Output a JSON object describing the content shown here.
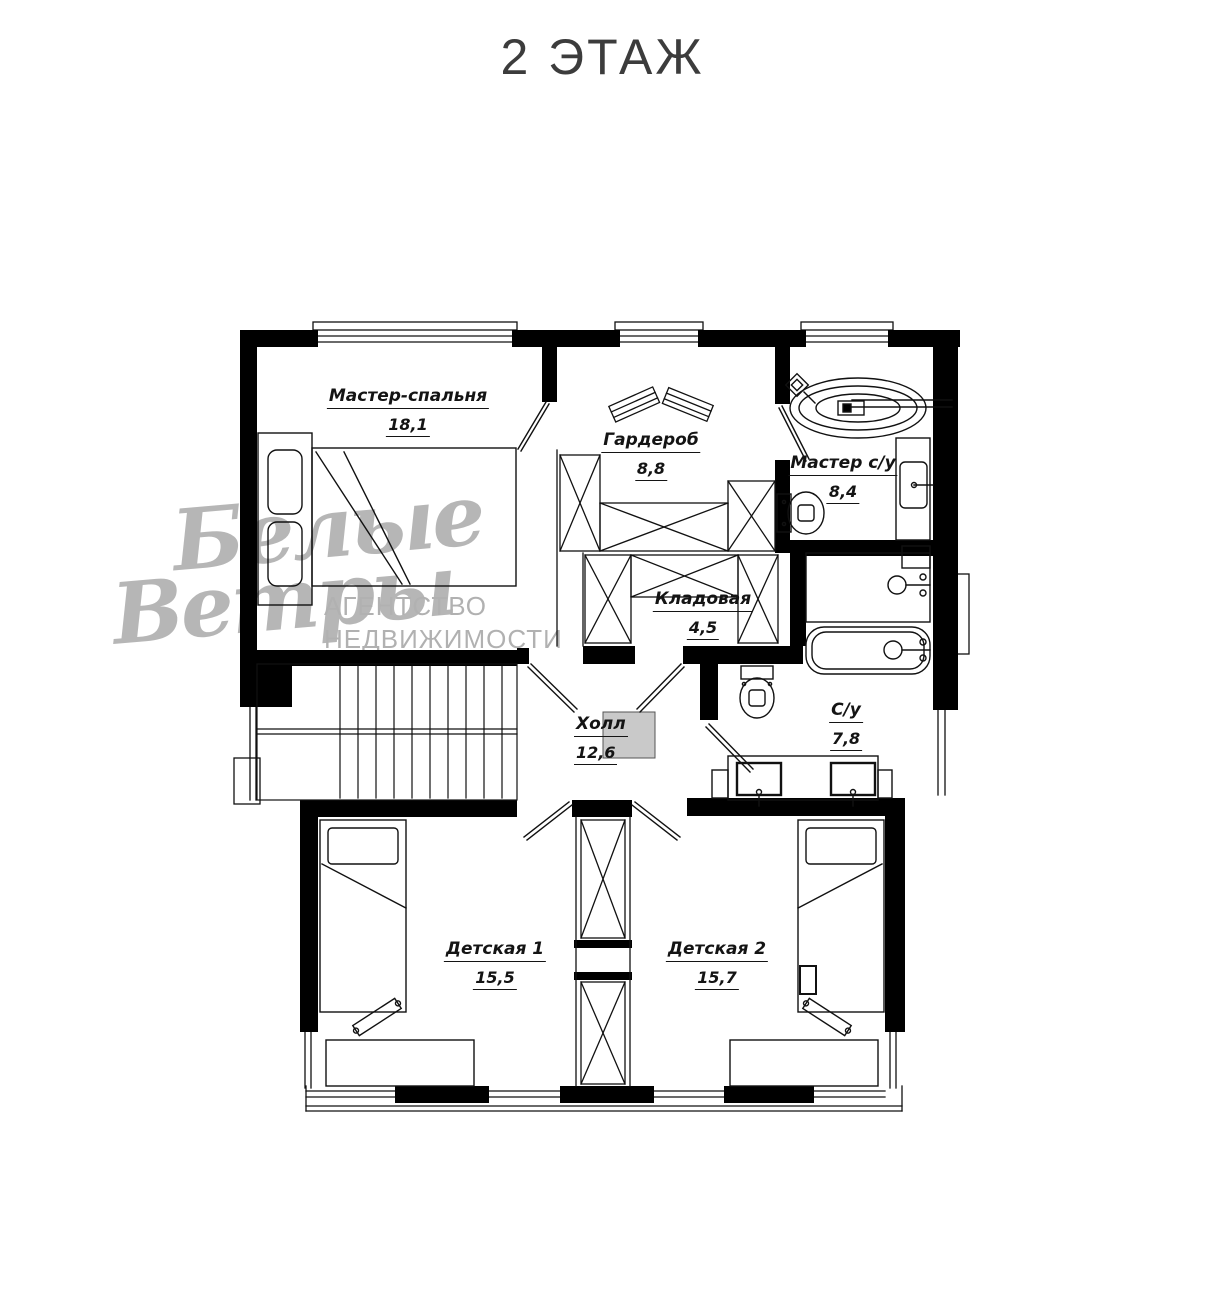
{
  "title": "2 ЭТАЖ",
  "agency_watermark": {
    "name_word1": "Белые",
    "name_word2": "Ветры",
    "tagline_line1": "АГЕНТСТВО",
    "tagline_line2": "НЕДВИЖИМОСТИ"
  },
  "rooms": [
    {
      "id": "master-bedroom",
      "name": "Мастер-спальня",
      "area": "18,1"
    },
    {
      "id": "wardrobe",
      "name": "Гардероб",
      "area": "8,8"
    },
    {
      "id": "master-bath",
      "name": "Мастер с/у",
      "area": "8,4"
    },
    {
      "id": "storage",
      "name": "Кладовая",
      "area": "4,5"
    },
    {
      "id": "hall",
      "name": "Холл",
      "area": "12,6"
    },
    {
      "id": "bathroom",
      "name": "С/у",
      "area": "7,8"
    },
    {
      "id": "kids-room-1",
      "name": "Детская 1",
      "area": "15,5"
    },
    {
      "id": "kids-room-2",
      "name": "Детская 2",
      "area": "15,7"
    }
  ],
  "colors": {
    "walls": "#000000",
    "plan_lines": "#111111",
    "watermark_gray": "#a5a5a5",
    "hall_shaft_fill": "#c9c9c9",
    "title_color": "#3c3c3c",
    "background": "#ffffff"
  }
}
